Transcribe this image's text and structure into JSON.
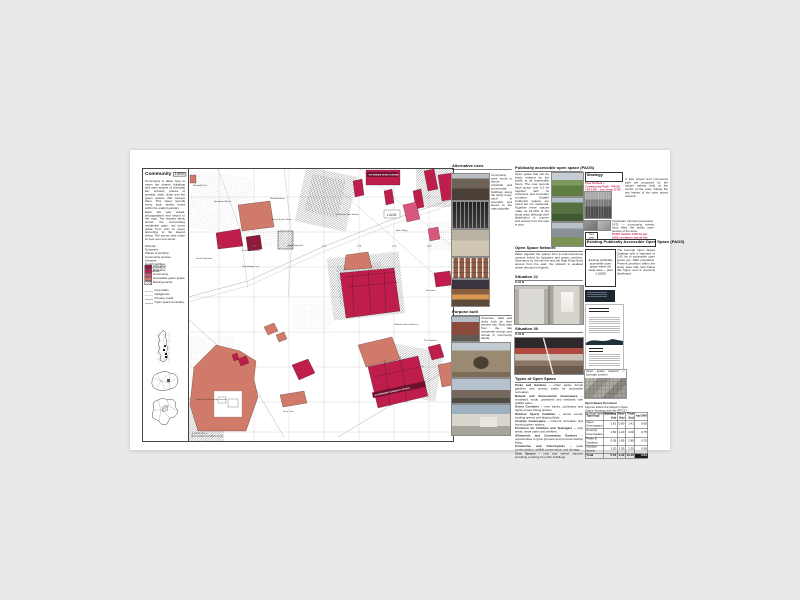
{
  "map": {
    "title": "Community",
    "scale": "1:5000",
    "intro": [
      "Community is taken here to mean the shared buildings and open spaces of everyday life: schools, places of worship, halls, clubs and the green spaces that connect them. This sheet records every such facility found within the study boundary.",
      "Each site was visited, photographed and keyed to the map. The shaded fabric shows the surrounding residential grain; red tones grade from civic to green according to the legend below. The survey was made on foot over one winter."
    ],
    "categories": [
      "Schools",
      "Nurseries",
      "Places of worship",
      "Community centres",
      "Libraries",
      "Health facilities",
      "Youth provision",
      "Allotments"
    ],
    "legend": {
      "swatches": [
        {
          "label": "Education",
          "color": "#8e1a3a"
        },
        {
          "label": "Religious",
          "color": "#bf1e4c"
        },
        {
          "label": "Community",
          "color": "#d9567c"
        },
        {
          "label": "Accessible green space",
          "color": "#d07a6a"
        },
        {
          "label": "Burial grounds",
          "color": "hatch"
        }
      ],
      "lines": [
        {
          "label": "Foot paths",
          "style": "dashed"
        },
        {
          "label": "Hedgerows",
          "style": "dotted"
        },
        {
          "label": "Primary roads",
          "style": "solid"
        },
        {
          "label": "Open space boundary",
          "style": "dashdot"
        }
      ]
    },
    "banners": [
      "TOTTENHAM SPORTS CENTRE",
      "GLADESMORE COMMUNITY SCHOOL"
    ],
    "area_ref": "LA16",
    "scalebar": "0    100    200    300 m",
    "labels": [
      {
        "text": "Markfield Park",
        "x": 5,
        "y": 17
      },
      {
        "text": "Springfield Marsh",
        "x": 26,
        "y": 33
      },
      {
        "text": "Markfield Road",
        "x": 82,
        "y": 30
      },
      {
        "text": "Seven Sisters Road",
        "x": 84,
        "y": 51
      },
      {
        "text": "Tottenham Hale Station",
        "x": 148,
        "y": 46
      },
      {
        "text": "Hale Village",
        "x": 208,
        "y": 62
      },
      {
        "text": "St Ignatius Church",
        "x": 54,
        "y": 82
      },
      {
        "text": "Holy Trinity Hall",
        "x": 100,
        "y": 77
      },
      {
        "text": "South Tottenham",
        "x": 8,
        "y": 90
      },
      {
        "text": "Stonebridge Lock",
        "x": 54,
        "y": 98
      },
      {
        "text": "Reservoir",
        "x": 238,
        "y": 122
      },
      {
        "text": "Paddock Nature Reserve",
        "x": 206,
        "y": 156
      },
      {
        "text": "The Paddock",
        "x": 236,
        "y": 172
      },
      {
        "text": "Down Lane Recreation Ground",
        "x": 8,
        "y": 231
      },
      {
        "text": "Ferry Lane",
        "x": 95,
        "y": 243
      },
      {
        "text": "274",
        "x": 30,
        "y": 78,
        "cls": "grid"
      },
      {
        "text": "275",
        "x": 64,
        "y": 78,
        "cls": "grid"
      },
      {
        "text": "276",
        "x": 99,
        "y": 78,
        "cls": "grid"
      },
      {
        "text": "277",
        "x": 134,
        "y": 78,
        "cls": "grid"
      },
      {
        "text": "278",
        "x": 169,
        "y": 78,
        "cls": "grid"
      },
      {
        "text": "279",
        "x": 204,
        "y": 78,
        "cls": "grid"
      },
      {
        "text": "280",
        "x": 239,
        "y": 78,
        "cls": "grid"
      }
    ]
  },
  "colA": {
    "h1": "Alternative uses",
    "text1": "Community uses found in former industrial and commercial buildings along the study route; each is recorded and keyed to the map opposite.",
    "h2": "Purpose built",
    "text2": "Churches, halls and clubs built for their present use. Most date from the late nineteenth century and remain in community hands."
  },
  "colB": {
    "h1": "Publically accessible open space (PAOS)",
    "text1": "Open space that can be freely entered by the public at all reasonable hours. The map records each space over 0.2 ha together with its entrances and boundary condition. Smaller incidental spaces are noted but not measured. Together these spaces make up 24.19% of the study area, although their distribution is uneven and access from the east is poor.",
    "h2": "Open Space Network",
    "text2": "Taken together the spaces form a near-continuous network linked by footpaths and green corridors. Severance by the rail line and the High Road limits access from the east; the network is weakest where demand is highest.",
    "h3": "Situation 21",
    "sub3": "S-31 B",
    "h4": "Situation 30",
    "sub4": "S-31 B",
    "h5": "Types of Open Space",
    "types": [
      {
        "lead": "Parks and Gardens –",
        "text": "urban parks, formal gardens and country parks for accessible recreation."
      },
      {
        "lead": "Natural and Semi-natural Greenspace –",
        "text": "woodland, scrub, grassland and wetlands with wildlife value."
      },
      {
        "lead": "Green Corridors –",
        "text": "river banks, cycleways and rights of way linking spaces."
      },
      {
        "lead": "Outdoor Sports Facilities –",
        "text": "tennis courts, bowling greens and playing fields."
      },
      {
        "lead": "Amenity Greenspace –",
        "text": "informal recreation and housing green spaces."
      },
      {
        "lead": "Provision for Children and Teenagers –",
        "text": "play areas, skate parks and shelters."
      },
      {
        "lead": "Allotments and Community Gardens –",
        "text": "opportunities to grow produce and promote healthy living."
      },
      {
        "lead": "Cemeteries and Churchyards –",
        "text": "quiet contemplation, wildlife conservation and heritage."
      },
      {
        "lead": "Civic Spaces –",
        "text": "civic and market squares providing a setting for public buildings."
      }
    ]
  },
  "colC": {
    "h1": "Strategy",
    "text1": "A free school and community park are proposed for the vacant railway land at the centre of the area, linking the two halves of the open space network.",
    "red_text": "Free School + Community Park · PAOS +24.19% · see sheet S-04",
    "photo_caption": "Tottenham carnival procession, 1971 — community events once filled the public open spaces of the area.",
    "key_label": "Key plan",
    "red_note": "PAOS deficit: 0.80 ha per 1000 residents below the borough standard.",
    "bar": "Existing Publically Accessible Open Space (PAOS)",
    "box_text": "Existing publically accessible open space within the study area — plan 1:10000",
    "text2": "The borough Open Space Strategy sets a standard of 2.41 ha of accessible open space per 1000 population. Present provision within the study area falls well below this figure and is unevenly distributed.",
    "thumb_caption": "Open space network — borough context",
    "table": {
      "title": "Open Space Provision",
      "caption": "Figures follow the Mayor's Open Space Strategy and the PPG17 typology assessment.",
      "headers": [
        "Typology",
        "Existing (ha)",
        "New (ha)",
        "Total (ha)",
        "ha/1000"
      ],
      "rows": [
        [
          "Open Greenspace",
          "1.61",
          "0.80",
          "2.41",
          "0.60"
        ],
        [
          "Amenity Greenspace",
          "1.80",
          "1.20",
          "3.00",
          "0.75"
        ],
        [
          "Parks & Gardens",
          "0.95",
          "1.85",
          "2.80",
          "0.70"
        ],
        [
          "Outdoor Sports",
          "1.20",
          "1.05",
          "2.25",
          "0.56"
        ],
        [
          "Total",
          "5.56",
          "4.90",
          "10.46",
          "2.61"
        ]
      ]
    }
  }
}
